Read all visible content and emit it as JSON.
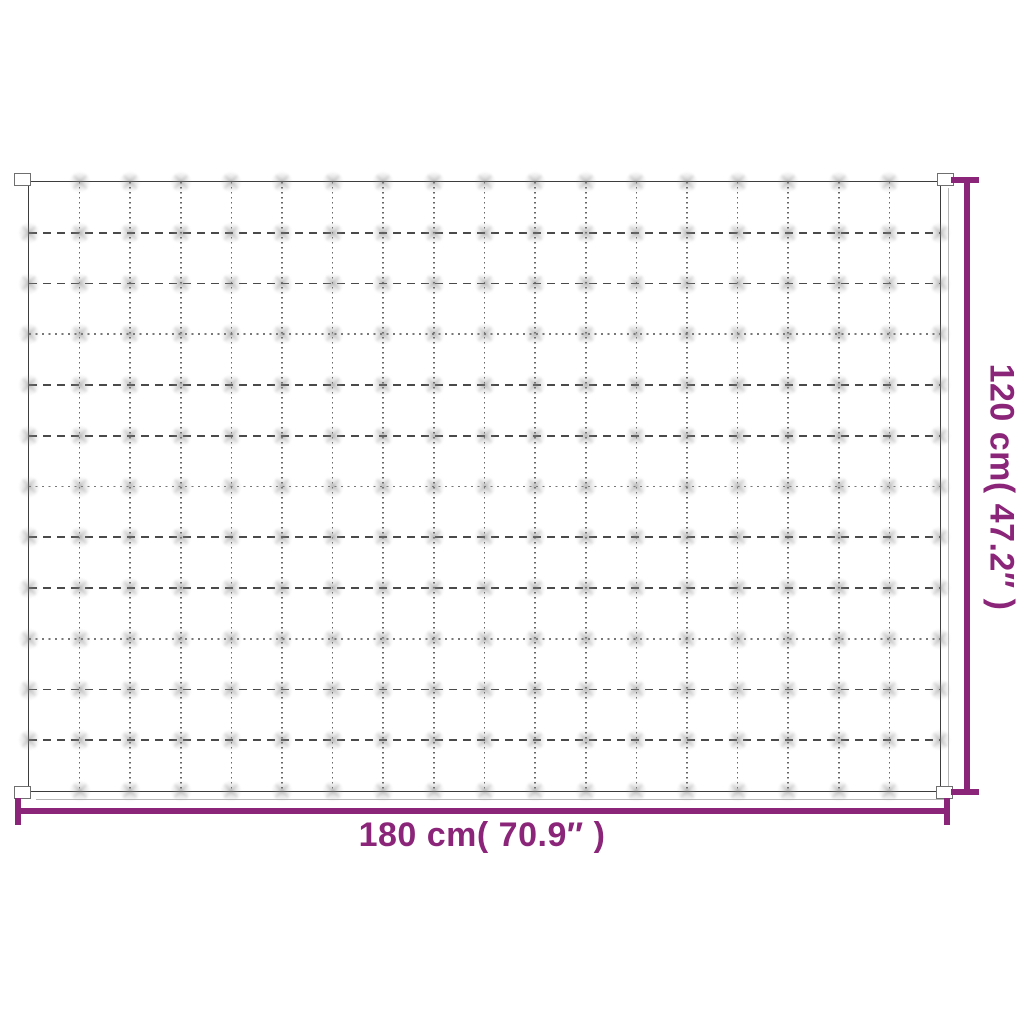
{
  "diagram": {
    "title": "blanket-dimension-diagram",
    "dimensions": {
      "width_label": "180 cm( 70.9″ )",
      "height_label": "120 cm( 47.2″ )"
    },
    "blanket": {
      "grid_cols": 18,
      "grid_rows": 12
    },
    "colors": {
      "accent": "#8b2579",
      "edge": "#3d3d3d",
      "stitch": "#555555"
    }
  }
}
